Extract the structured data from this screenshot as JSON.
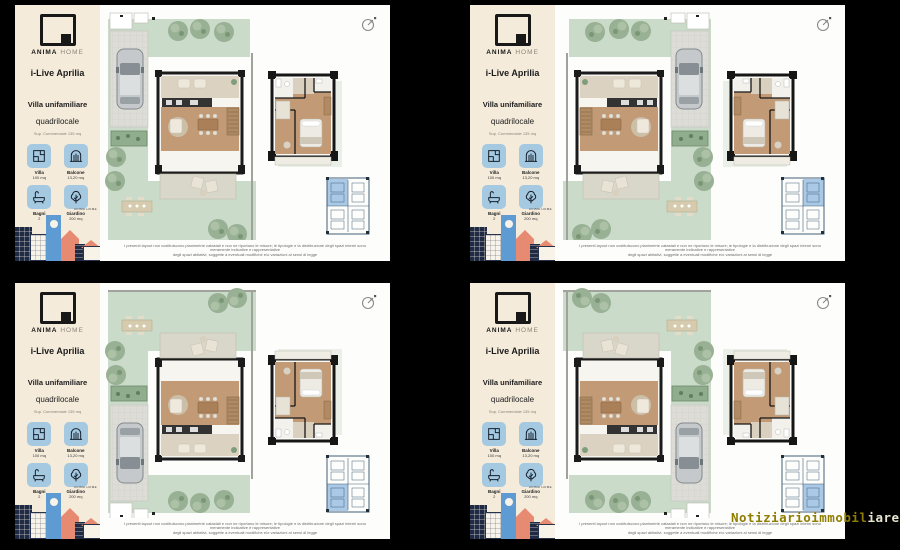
{
  "brand": {
    "name_bold": "ANIMA",
    "name_light": "HOME"
  },
  "sidebar": {
    "project": "i-Live Aprilia",
    "type": "Villa unifamiliare",
    "layout": "quadrilocale",
    "surface": "Sup. Commerciale 135 mq",
    "stats": [
      {
        "icon": "floorplan-icon",
        "label": "Villa",
        "value": "100 mq"
      },
      {
        "icon": "balcony-icon",
        "label": "Balcone",
        "value": "13,20 mq"
      },
      {
        "icon": "bath-icon",
        "label": "Bagni",
        "value": "2"
      },
      {
        "icon": "tree-icon",
        "label": "Giardino",
        "value": "200 mq"
      }
    ],
    "footer_brand": "ANIMA HOME"
  },
  "plan": {
    "disclaimer_line1": "I presenti layout non costituiscono planimetrie catastali e non ne riportano le misure; le tipologie e la distribuzione degli spazi interni sono meramente indicative e rappresentative",
    "disclaimer_line2": "degli spazi abitativi, soggette a eventuali modifiche e/o variazioni ai sensi di legge"
  },
  "watermark": {
    "part1": "Notiziarioimmobil",
    "part2": "iare.it"
  },
  "colors": {
    "sidebar_bg": "#f4ebdb",
    "tile_blue": "#a5c9e1",
    "inset_highlight": "#a9c9e6",
    "garden_green": "#cbdbc9",
    "tree_green": "#98b093",
    "wood_floor": "#c29b76",
    "wall_black": "#1b1b1b",
    "illustration_navy": "#1f2a44",
    "illustration_blue": "#5f9bd3",
    "illustration_salmon": "#e78a72",
    "watermark_yellow": "#8f7d00"
  }
}
